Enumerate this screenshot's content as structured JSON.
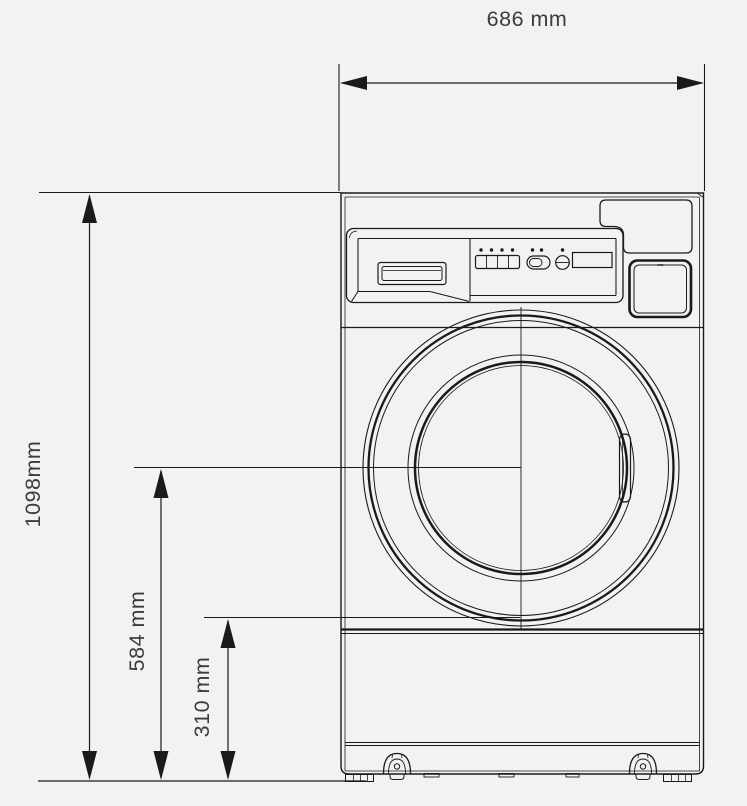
{
  "page": {
    "background_color": "#f2f2f2",
    "line_color": "#1a1a1a",
    "text_color": "#3b3b41"
  },
  "diagram": {
    "type": "technical-dimension-drawing",
    "dimensions": {
      "overall_width": {
        "label": "686 mm"
      },
      "overall_height": {
        "label": "1098mm"
      },
      "door_center_height": {
        "label": "584 mm"
      },
      "lower_reference_height": {
        "label": "310 mm"
      }
    }
  }
}
